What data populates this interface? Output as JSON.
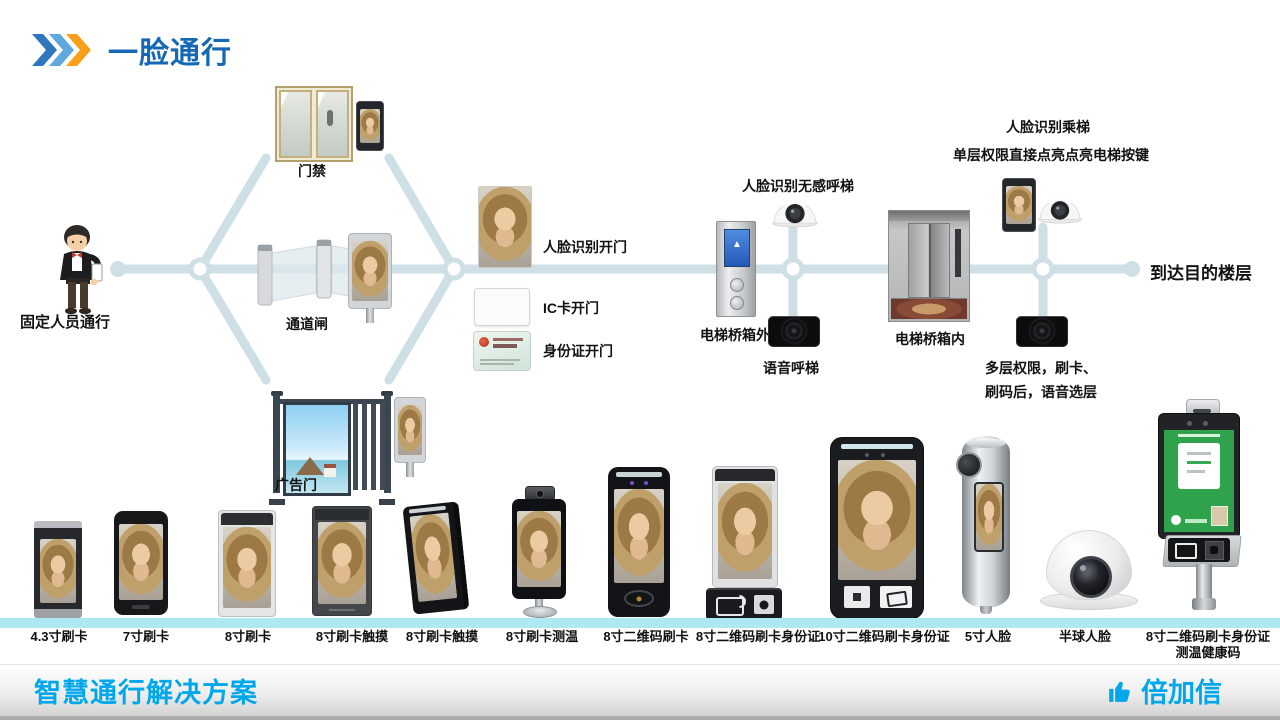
{
  "title": {
    "text": "一脸通行",
    "icon": "triple-chevron-icon"
  },
  "flow": {
    "start": {
      "label": "固定人员通行",
      "icon": "person-with-phone-illustration"
    },
    "branches": [
      {
        "label": "门禁",
        "icon": "glass-door-photo"
      },
      {
        "label": "通道闸",
        "icon": "swing-gate-photo"
      },
      {
        "label": "广告门",
        "icon": "ad-gate-photo"
      }
    ],
    "open_methods": [
      {
        "label": "人脸识别开门",
        "icon": "face-photo"
      },
      {
        "label": "IC卡开门",
        "icon": "ic-card"
      },
      {
        "label": "身份证开门",
        "icon": "id-card"
      }
    ],
    "elevator_outside": {
      "call_label": "人脸识别无感呼梯",
      "panel_label": "电梯桥箱外",
      "panel_arrow": "▲",
      "voice_label": "语音呼梯"
    },
    "elevator_inside": {
      "ride_label": "人脸识别乘梯",
      "single_floor_label": "单层权限直接点亮点亮电梯按键",
      "cabin_label": "电梯桥箱内",
      "multi_floor_line1": "多层权限，刷卡、",
      "multi_floor_line2": "刷码后，语音选层"
    },
    "end": {
      "label": "到达目的楼层"
    }
  },
  "products": {
    "items": [
      {
        "label": "4.3寸刷卡"
      },
      {
        "label": "7寸刷卡"
      },
      {
        "label": "8寸刷卡"
      },
      {
        "label": "8寸刷卡触摸"
      },
      {
        "label": "8寸刷卡触摸"
      },
      {
        "label": "8寸刷卡测温"
      },
      {
        "label": "8寸二维码刷卡"
      },
      {
        "label": "8寸二维码刷卡身份证"
      },
      {
        "label": "10寸二维码刷卡身份证"
      },
      {
        "label": "5寸人脸"
      },
      {
        "label": "半球人脸"
      },
      {
        "label": "8寸二维码刷卡身份证",
        "label2": "测温健康码"
      }
    ]
  },
  "footer": {
    "solution_label": "智慧通行解决方案",
    "brand_label": "倍加信",
    "brand_icon": "thumbs-up-icon"
  },
  "colors": {
    "title_blue": "#1568b4",
    "chevron_blue": "#2d77bd",
    "chevron_light_blue": "#5fa8dc",
    "chevron_orange": "#f8a01c",
    "connector": "#cfdfe6",
    "accent_cyan": "#00a7ea",
    "strip_cyan": "#aee8f2"
  }
}
